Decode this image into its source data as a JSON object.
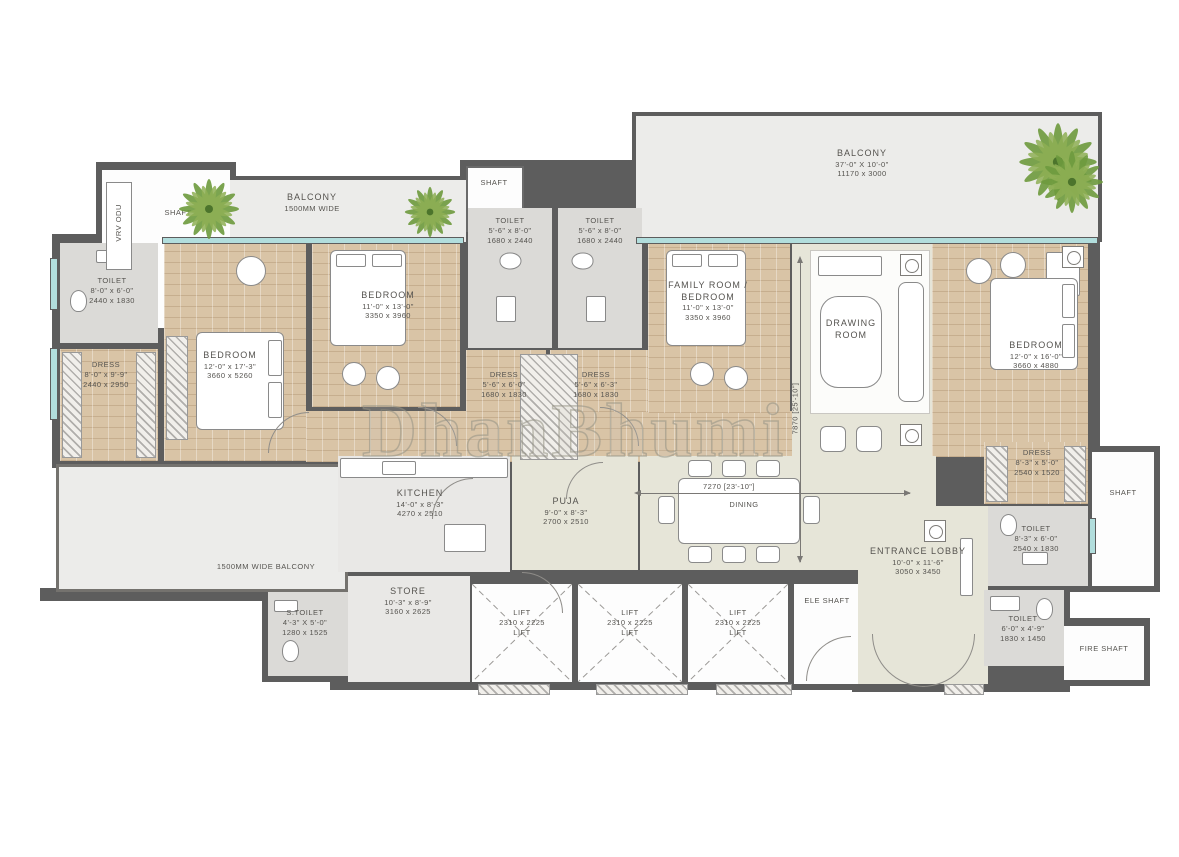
{
  "watermark": "DhanBhumi",
  "dimensions": {
    "horizontal": "7270 [23'-10\"]",
    "vertical": "7870 [25'-10\"]"
  },
  "colors": {
    "wall": "#5d5d5d",
    "wood_floor": "#d9c4a6",
    "living_floor": "#e6e5d8",
    "toilet_floor": "#dbdad7",
    "balcony_floor": "#ececea",
    "window": "#b2dedd",
    "plant_green": "#6e9b3e",
    "label_text": "#55534f"
  },
  "rooms": {
    "balcony1": {
      "name": "BALCONY",
      "l1": "1500MM WIDE"
    },
    "vrv": {
      "name": "VRV ODU"
    },
    "shaft1": {
      "name": "SHAFT"
    },
    "shaft2": {
      "name": "SHAFT"
    },
    "toilet_tl": {
      "name": "TOILET",
      "ft": "8'-0\" x 6'-0\"",
      "mm": "2440 x 1830"
    },
    "dress_l": {
      "name": "DRESS",
      "ft": "8'-0\" x 9'-9\"",
      "mm": "2440 x 2950"
    },
    "bedroom1": {
      "name": "BEDROOM",
      "ft": "12'-0\" x 17'-3\"",
      "mm": "3660 x 5260"
    },
    "bedroom2": {
      "name": "BEDROOM",
      "ft": "11'-0\" x 13'-0\"",
      "mm": "3350 x 3960"
    },
    "toilet_m1": {
      "name": "TOILET",
      "ft": "5'-6\" x 8'-0\"",
      "mm": "1680 x 2440"
    },
    "toilet_m2": {
      "name": "TOILET",
      "ft": "5'-6\" x 8'-0\"",
      "mm": "1680 x 2440"
    },
    "balcony2": {
      "name": "BALCONY",
      "ft": "37'-0\" X 10'-0\"",
      "mm": "11170 x 3000"
    },
    "dress_m1": {
      "name": "DRESS",
      "ft": "5'-6\" x 6'-0\"",
      "mm": "1680 x 1830"
    },
    "dress_m2": {
      "name": "DRESS",
      "ft": "5'-6\" x 6'-3\"",
      "mm": "1680 x 1830"
    },
    "family": {
      "name": "FAMILY ROOM / BEDROOM",
      "ft": "11'-0\" x 13'-0\"",
      "mm": "3350 x 3960"
    },
    "drawing": {
      "name": "DRAWING ROOM"
    },
    "bedroom4": {
      "name": "BEDROOM",
      "ft": "12'-0\" x 16'-0\"",
      "mm": "3660 x 4880"
    },
    "dress_r": {
      "name": "DRESS",
      "ft": "8'-3\" x 5'-0\"",
      "mm": "2540 x 1520"
    },
    "shaft_r": {
      "name": "SHAFT"
    },
    "toilet_r1": {
      "name": "TOILET",
      "ft": "8'-3\" x 6'-0\"",
      "mm": "2540 x 1830"
    },
    "kitchen": {
      "name": "KITCHEN",
      "ft": "14'-0\" x 8'-3\"",
      "mm": "4270 x 2510"
    },
    "puja": {
      "name": "PUJA",
      "ft": "9'-0\" x 8'-3\"",
      "mm": "2700 x 2510"
    },
    "dining": {
      "name": "DINING"
    },
    "balcony3": {
      "name": "1500MM WIDE BALCONY"
    },
    "s_toilet": {
      "name": "S.TOILET",
      "ft": "4'-3\" X 5'-0\"",
      "mm": "1280 x 1525"
    },
    "store": {
      "name": "STORE",
      "ft": "10'-3\" x 8'-9\"",
      "mm": "3160 x 2625"
    },
    "lift1": {
      "name": "LIFT",
      "mm": "2310 x 2225",
      "l2": "LIFT"
    },
    "lift2": {
      "name": "LIFT",
      "mm": "2310 x 2225",
      "l2": "LIFT"
    },
    "lift3": {
      "name": "LIFT",
      "mm": "2310 x 2225",
      "l2": "LIFT"
    },
    "ele_shaft": {
      "name": "ELE SHAFT"
    },
    "lobby": {
      "name": "ENTRANCE LOBBY",
      "ft": "10'-0\" x 11'-6\"",
      "mm": "3050 x 3450"
    },
    "toilet_r2": {
      "name": "TOILET",
      "ft": "6'-0\" x 4'-9\"",
      "mm": "1830 x 1450"
    },
    "fire_shaft": {
      "name": "FIRE SHAFT"
    }
  }
}
